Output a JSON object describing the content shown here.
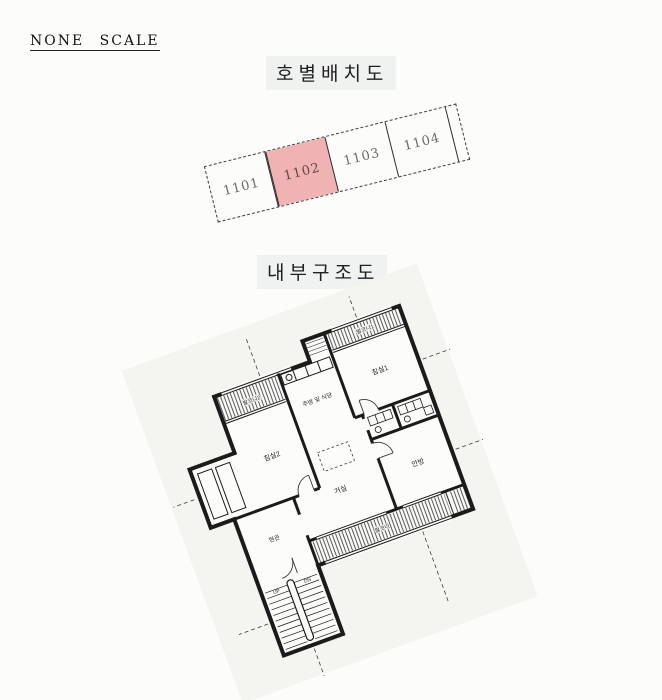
{
  "scale_label": "NONE SCALE",
  "unit_layout": {
    "title": "호별배치도",
    "highlight_color": "#f0b2b2",
    "units": [
      {
        "number": "1101",
        "highlighted": false
      },
      {
        "number": "1102",
        "highlighted": true
      },
      {
        "number": "1103",
        "highlighted": false
      },
      {
        "number": "1104",
        "highlighted": false
      }
    ]
  },
  "floor_plan": {
    "title": "내부구조도",
    "rooms": {
      "bedroom1": "침실1",
      "bedroom2": "침실2",
      "kitchen": "주방 및 식당",
      "living": "거실",
      "master": "안방",
      "entrance": "현관",
      "balcony1": "발코니1",
      "balcony2": "발코니2",
      "balcony3": "발코니",
      "stairs_up": "UP",
      "stairs_down": "DN"
    }
  }
}
